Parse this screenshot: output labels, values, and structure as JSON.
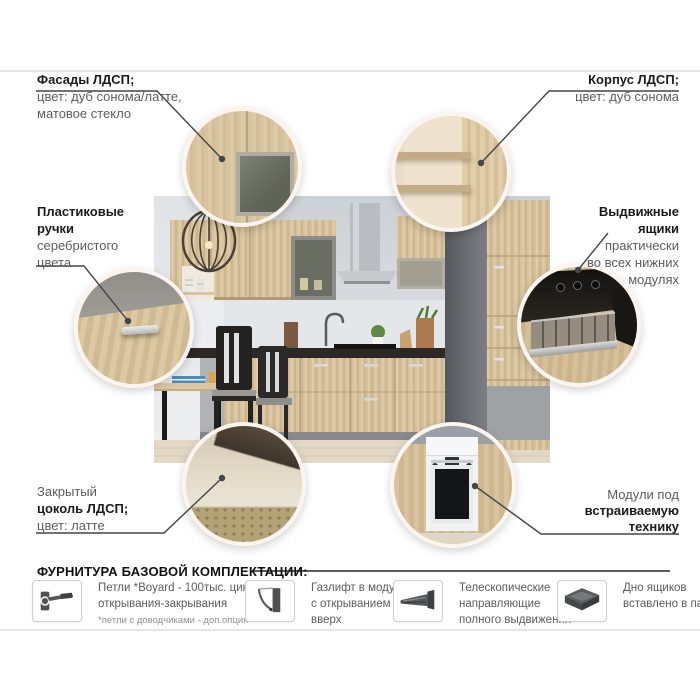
{
  "callouts": {
    "facades": {
      "title": "Фасады ЛДСП;",
      "lines": [
        "цвет: дуб сонома/латте,",
        "матовое стекло"
      ]
    },
    "carcass": {
      "title": "Корпус ЛДСП;",
      "lines": [
        "цвет: дуб сонома"
      ]
    },
    "handles": {
      "title_lines": [
        "Пластиковые",
        "ручки"
      ],
      "lines": [
        "серебристого",
        "цвета"
      ]
    },
    "drawers": {
      "title_lines": [
        "Выдвижные",
        "ящики"
      ],
      "lines": [
        "практически",
        "во всех нижних",
        "модулях"
      ]
    },
    "plinth": {
      "pre": "Закрытый",
      "title": "цоколь ЛДСП;",
      "lines": [
        "цвет: латте"
      ]
    },
    "builtin": {
      "pre": "Модули под",
      "title_lines": [
        "встраиваемую",
        "технику"
      ]
    }
  },
  "hardware": {
    "title": "ФУРНИТУРА БАЗОВОЙ КОМПЛЕКТАЦИИ:",
    "items": [
      {
        "icon": "hinge-icon",
        "lines": [
          "Петли *Boyard - 100тыс. циклов",
          "открывания-закрывания"
        ],
        "note": "*петли с доводчиками - доп.опция"
      },
      {
        "icon": "gas-lift-icon",
        "lines": [
          "Газлифт в модулях",
          "с открыванием",
          "вверх"
        ]
      },
      {
        "icon": "telescopic-rails-icon",
        "lines": [
          "Телескопические",
          "направляющие",
          "полного выдвижения"
        ]
      },
      {
        "icon": "drawer-bottom-icon",
        "lines": [
          "Дно ящиков",
          "вставлено в паз"
        ]
      }
    ]
  },
  "colors": {
    "connector_line": "#454545",
    "title_text": "#1b1b1b",
    "body_text": "#5c5c5c",
    "wood_light": "#d7c29c",
    "counter_dark": "#2b2826",
    "wall_gray": "#d4d8dc",
    "column_gray": "#6b6f73",
    "ring_white": "#fcf5ef",
    "icon_gray": "#55575a",
    "hairline": "#e6e6e3"
  }
}
